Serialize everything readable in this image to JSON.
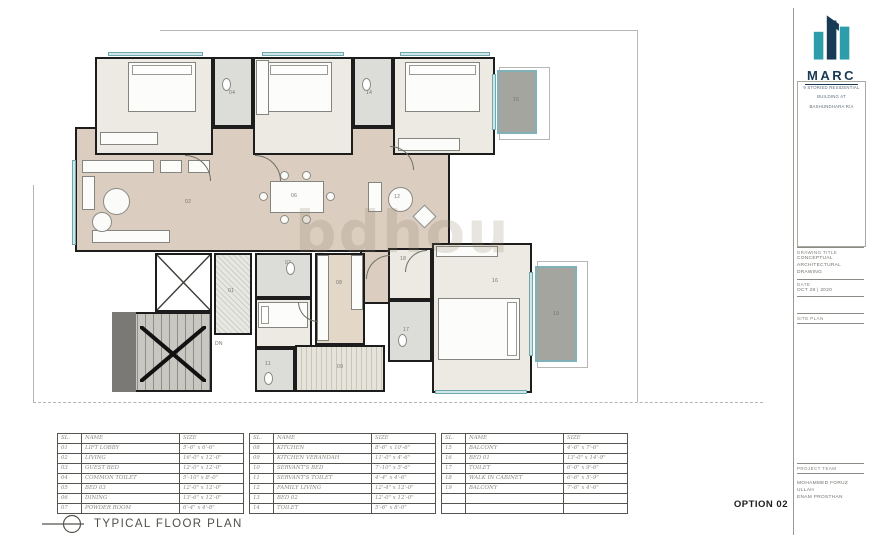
{
  "logo": {
    "name": "MARC",
    "teal": "#2d9dab",
    "navy": "#173a56",
    "subtitle_lines": [
      "9 STORIED RESIDENTIAL",
      "BUILDING AT",
      "BASHUNDHARA R/A"
    ]
  },
  "title_block": {
    "drawing_title_label": "DRAWING TITLE",
    "drawing_title_line1": "CONCEPTUAL",
    "drawing_title_line2": "ARCHITECTURAL DRAWING",
    "date_label": "DATE",
    "date_value": "OCT 28 | 2020",
    "site_plan_label": "SITE PLAN",
    "project_team_label": "PROJECT TEAM",
    "team_lines": [
      "MOHAMMED FORUZ ULLAH",
      "ENAM PROSTHAN"
    ]
  },
  "footer": {
    "plan_title": "TYPICAL FLOOR PLAN",
    "option": "OPTION 02"
  },
  "watermark": "bdhou",
  "tables": [
    {
      "headers": [
        "SL.",
        "NAME",
        "SIZE"
      ],
      "rows": [
        [
          "01",
          "LIFT LOBBY",
          "5'-6\" x 6'-6\""
        ],
        [
          "02",
          "LIVING",
          "16'-0\" x 12'-0\""
        ],
        [
          "03",
          "GUEST BED",
          "12'-0\" x 12'-0\""
        ],
        [
          "04",
          "COMMON TOILET",
          "5'-10\" x 8'-0\""
        ],
        [
          "05",
          "BED 03",
          "12'-0\" x 12'-0\""
        ],
        [
          "06",
          "DINING",
          "13'-6\" x 12'-0\""
        ],
        [
          "07",
          "POWDER ROOM",
          "6'-4\" x 4'-8\""
        ]
      ]
    },
    {
      "headers": [
        "SL.",
        "NAME",
        "SIZE"
      ],
      "rows": [
        [
          "08",
          "KITCHEN",
          "8'-6\" x 10'-6\""
        ],
        [
          "09",
          "KITCHEN VERANDAH",
          "11'-0\" x 4'-6\""
        ],
        [
          "10",
          "SERVANT'S BED",
          "7'-10\" x 5'-6\""
        ],
        [
          "11",
          "SERVANT'S TOILET",
          "4'-4\" x 4'-6\""
        ],
        [
          "12",
          "FAMILY LIVING",
          "12'-4\" x 12'-0\""
        ],
        [
          "13",
          "BED 02",
          "12'-0\" x 12'-0\""
        ],
        [
          "14",
          "TOILET",
          "5'-6\" x 8'-0\""
        ]
      ]
    },
    {
      "headers": [
        "SL.",
        "NAME",
        "SIZE"
      ],
      "rows": [
        [
          "15",
          "BALCONY",
          "4'-6\" x 7'-6\""
        ],
        [
          "16",
          "BED 01",
          "13'-0\" x 14'-9\""
        ],
        [
          "17",
          "TOILET",
          "6'-0\" x 9'-6\""
        ],
        [
          "18",
          "WALK IN CABINET",
          "6'-6\" x 5'-9\""
        ],
        [
          "19",
          "BALCONY",
          "7'-6\" x 4'-6\""
        ],
        [
          "",
          "",
          ""
        ],
        [
          "",
          "",
          ""
        ]
      ]
    }
  ],
  "floor_plan": {
    "boundaries": [
      {
        "x": 160,
        "y": 30,
        "w": 478,
        "h": 0,
        "style": "solid"
      },
      {
        "x": 637,
        "y": 30,
        "w": 0,
        "h": 372,
        "style": "solid"
      },
      {
        "x": 33,
        "y": 185,
        "w": 0,
        "h": 217,
        "style": "solid"
      },
      {
        "x": 33,
        "y": 402,
        "w": 730,
        "h": 0,
        "style": "dashed"
      },
      {
        "x": 499,
        "y": 67,
        "w": 49,
        "h": 71,
        "style": "box"
      },
      {
        "x": 537,
        "y": 261,
        "w": 49,
        "h": 105,
        "style": "box"
      }
    ],
    "rooms": [
      {
        "id": "circulation-living-dining",
        "label": "",
        "x": 75,
        "y": 127,
        "w": 375,
        "h": 125,
        "floor": "beige"
      },
      {
        "id": "foyer",
        "label": "",
        "x": 360,
        "y": 250,
        "w": 30,
        "h": 54,
        "floor": "beige"
      },
      {
        "id": "guest-bed-room",
        "label": "03",
        "x": 95,
        "y": 57,
        "w": 118,
        "h": 98,
        "floor": "cream",
        "label_at": [
          36,
          32
        ]
      },
      {
        "id": "common-toilet-room",
        "label": "04",
        "x": 213,
        "y": 57,
        "w": 40,
        "h": 70,
        "floor": "toilet",
        "label_at": [
          14,
          32
        ]
      },
      {
        "id": "bed-03-room",
        "label": "05",
        "x": 253,
        "y": 57,
        "w": 100,
        "h": 98,
        "floor": "cream",
        "label_at": [
          26,
          32
        ]
      },
      {
        "id": "toilet-14-room",
        "label": "14",
        "x": 353,
        "y": 57,
        "w": 40,
        "h": 70,
        "floor": "toilet",
        "label_at": [
          11,
          32
        ]
      },
      {
        "id": "bed-02-room",
        "label": "13",
        "x": 393,
        "y": 57,
        "w": 102,
        "h": 98,
        "floor": "cream",
        "label_at": [
          60,
          32
        ]
      },
      {
        "id": "balcony-15-room",
        "label": "15",
        "x": 497,
        "y": 70,
        "w": 40,
        "h": 64,
        "floor": "balcony",
        "label_at": [
          14,
          26
        ]
      },
      {
        "id": "lift-shaft",
        "label": "",
        "x": 155,
        "y": 253,
        "w": 57,
        "h": 59,
        "floor": "white"
      },
      {
        "id": "stair",
        "label": "",
        "x": 112,
        "y": 312,
        "w": 100,
        "h": 80,
        "floor": "stair"
      },
      {
        "id": "lift-lobby-room",
        "label": "01",
        "x": 214,
        "y": 253,
        "w": 38,
        "h": 82,
        "floor": "lobby",
        "label_at": [
          12,
          34
        ]
      },
      {
        "id": "powder-room",
        "label": "07",
        "x": 255,
        "y": 253,
        "w": 57,
        "h": 45,
        "floor": "toilet",
        "label_at": [
          28,
          6
        ]
      },
      {
        "id": "servants-bed-room",
        "label": "10",
        "x": 255,
        "y": 298,
        "w": 57,
        "h": 50,
        "floor": "cream",
        "label_at": [
          16,
          18
        ]
      },
      {
        "id": "servants-toilet-room",
        "label": "11",
        "x": 255,
        "y": 348,
        "w": 40,
        "h": 44,
        "floor": "toilet",
        "label_at": [
          8,
          12
        ]
      },
      {
        "id": "kitchen-verandah-room",
        "label": "09",
        "x": 295,
        "y": 345,
        "w": 90,
        "h": 47,
        "floor": "verandah",
        "label_at": [
          40,
          18
        ]
      },
      {
        "id": "kitchen-room",
        "label": "08",
        "x": 315,
        "y": 253,
        "w": 50,
        "h": 92,
        "floor": "kitchen",
        "label_at": [
          19,
          26
        ]
      },
      {
        "id": "walk-in-cabinet-room",
        "label": "18",
        "x": 388,
        "y": 248,
        "w": 44,
        "h": 52,
        "floor": "cream",
        "label_at": [
          10,
          7
        ]
      },
      {
        "id": "toilet-17-room",
        "label": "17",
        "x": 388,
        "y": 300,
        "w": 44,
        "h": 62,
        "floor": "toilet",
        "label_at": [
          13,
          26
        ]
      },
      {
        "id": "bed-01-room",
        "label": "16",
        "x": 432,
        "y": 243,
        "w": 100,
        "h": 150,
        "floor": "cream",
        "label_at": [
          58,
          34
        ]
      },
      {
        "id": "balcony-19-room",
        "label": "19",
        "x": 535,
        "y": 266,
        "w": 42,
        "h": 96,
        "floor": "balcony",
        "label_at": [
          16,
          44
        ]
      }
    ],
    "windows": [
      {
        "x": 108,
        "y": 52,
        "w": 95,
        "h": 4
      },
      {
        "x": 262,
        "y": 52,
        "w": 82,
        "h": 4
      },
      {
        "x": 400,
        "y": 52,
        "w": 90,
        "h": 4
      },
      {
        "x": 72,
        "y": 160,
        "w": 4,
        "h": 85
      },
      {
        "x": 492,
        "y": 74,
        "w": 4,
        "h": 56
      },
      {
        "x": 529,
        "y": 272,
        "w": 4,
        "h": 84
      },
      {
        "x": 435,
        "y": 390,
        "w": 92,
        "h": 4
      }
    ],
    "furniture": [
      {
        "t": "bed",
        "x": 128,
        "y": 62,
        "w": 68,
        "h": 50,
        "head": "top"
      },
      {
        "t": "bed",
        "x": 266,
        "y": 62,
        "w": 66,
        "h": 50,
        "head": "top"
      },
      {
        "t": "bed",
        "x": 405,
        "y": 62,
        "w": 75,
        "h": 50,
        "head": "top"
      },
      {
        "t": "bed",
        "x": 438,
        "y": 298,
        "w": 82,
        "h": 62,
        "head": "right"
      },
      {
        "t": "bed",
        "x": 258,
        "y": 302,
        "w": 50,
        "h": 26,
        "head": "left"
      },
      {
        "t": "wardrobe",
        "x": 100,
        "y": 132,
        "w": 58,
        "h": 13
      },
      {
        "t": "wardrobe",
        "x": 256,
        "y": 60,
        "w": 13,
        "h": 55
      },
      {
        "t": "wardrobe",
        "x": 398,
        "y": 138,
        "w": 62,
        "h": 13
      },
      {
        "t": "wardrobe",
        "x": 436,
        "y": 246,
        "w": 62,
        "h": 11
      },
      {
        "t": "table",
        "x": 270,
        "y": 181,
        "w": 54,
        "h": 32
      },
      {
        "t": "chair",
        "x": 280,
        "y": 171,
        "w": 9,
        "h": 9
      },
      {
        "t": "chair",
        "x": 302,
        "y": 171,
        "w": 9,
        "h": 9
      },
      {
        "t": "chair",
        "x": 280,
        "y": 215,
        "w": 9,
        "h": 9
      },
      {
        "t": "chair",
        "x": 302,
        "y": 215,
        "w": 9,
        "h": 9
      },
      {
        "t": "chair",
        "x": 259,
        "y": 192,
        "w": 9,
        "h": 9
      },
      {
        "t": "chair",
        "x": 326,
        "y": 192,
        "w": 9,
        "h": 9
      },
      {
        "t": "sofa",
        "x": 82,
        "y": 160,
        "w": 72,
        "h": 13
      },
      {
        "t": "sofa",
        "x": 82,
        "y": 176,
        "w": 13,
        "h": 34
      },
      {
        "t": "sofa",
        "x": 92,
        "y": 230,
        "w": 78,
        "h": 13
      },
      {
        "t": "sofa",
        "x": 160,
        "y": 160,
        "w": 22,
        "h": 13
      },
      {
        "t": "sofa",
        "x": 188,
        "y": 160,
        "w": 22,
        "h": 13
      },
      {
        "t": "roundtable",
        "x": 103,
        "y": 188,
        "w": 27,
        "h": 27
      },
      {
        "t": "roundtable",
        "x": 92,
        "y": 212,
        "w": 20,
        "h": 20
      },
      {
        "t": "roundtable",
        "x": 388,
        "y": 187,
        "w": 25,
        "h": 25
      },
      {
        "t": "sofa",
        "x": 368,
        "y": 182,
        "w": 14,
        "h": 30
      },
      {
        "t": "diamond",
        "x": 416,
        "y": 208,
        "w": 17,
        "h": 17
      },
      {
        "t": "counter",
        "x": 317,
        "y": 255,
        "w": 12,
        "h": 86
      },
      {
        "t": "counter",
        "x": 351,
        "y": 255,
        "w": 12,
        "h": 55
      },
      {
        "t": "wc",
        "x": 222,
        "y": 78,
        "w": 9,
        "h": 13
      },
      {
        "t": "wc",
        "x": 362,
        "y": 78,
        "w": 9,
        "h": 13
      },
      {
        "t": "wc",
        "x": 286,
        "y": 262,
        "w": 9,
        "h": 13
      },
      {
        "t": "wc",
        "x": 264,
        "y": 372,
        "w": 9,
        "h": 13
      },
      {
        "t": "wc",
        "x": 398,
        "y": 334,
        "w": 9,
        "h": 13
      },
      {
        "t": "landing",
        "x": 112,
        "y": 312,
        "w": 24,
        "h": 80
      },
      {
        "t": "cross",
        "x": 157,
        "y": 255,
        "w": 53,
        "h": 55,
        "bold": false
      },
      {
        "t": "cross",
        "x": 140,
        "y": 326,
        "w": 66,
        "h": 56,
        "bold": true
      },
      {
        "t": "door",
        "x": 185,
        "y": 129,
        "w": 26,
        "rot": 90
      },
      {
        "t": "door",
        "x": 255,
        "y": 129,
        "w": 26,
        "rot": 90
      },
      {
        "t": "door",
        "x": 390,
        "y": 122,
        "w": 24,
        "rot": 90
      },
      {
        "t": "door",
        "x": 366,
        "y": 255,
        "w": 24,
        "rot": 0
      },
      {
        "t": "door",
        "x": 405,
        "y": 250,
        "w": 22,
        "rot": 0
      },
      {
        "t": "door",
        "x": 318,
        "y": 302,
        "w": 20,
        "rot": 270
      }
    ],
    "labels": [
      {
        "t": "02",
        "x": 185,
        "y": 200
      },
      {
        "t": "06",
        "x": 291,
        "y": 194
      },
      {
        "t": "12",
        "x": 394,
        "y": 195
      },
      {
        "t": "DN",
        "x": 215,
        "y": 342
      }
    ]
  }
}
